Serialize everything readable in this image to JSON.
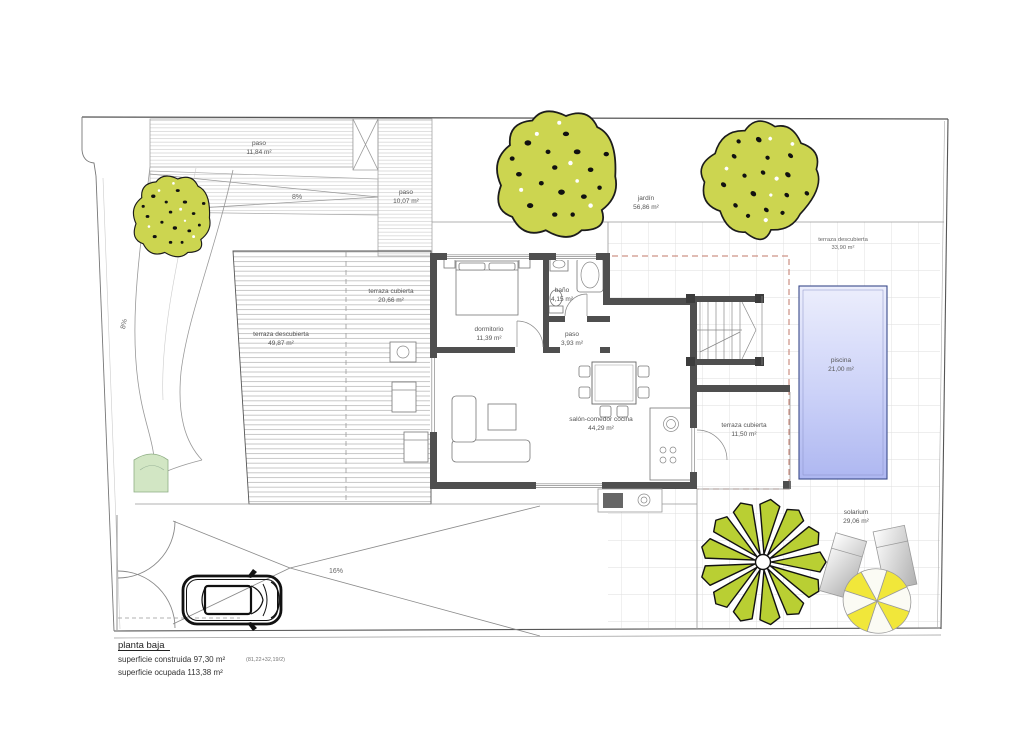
{
  "labels": {
    "paso_top": {
      "name": "paso",
      "area": "11,84 m²"
    },
    "paso_mid": {
      "name": "paso",
      "area": "10,07 m²"
    },
    "jardin": {
      "name": "jardín",
      "area": "56,86 m²"
    },
    "terraza_descubierta_ne": {
      "name": "terraza descubierta",
      "area": "33,90 m²"
    },
    "terraza_cubierta_oeste": {
      "name": "terraza cubierta",
      "area": "20,66 m²"
    },
    "terraza_descubierta_oeste": {
      "name": "terraza descubierta",
      "area": "49,87 m²"
    },
    "dormitorio": {
      "name": "dormitorio",
      "area": "11,39 m²"
    },
    "bano": {
      "name": "baño",
      "area": "4,15 m²"
    },
    "paso_interior": {
      "name": "paso",
      "area": "3,93 m²"
    },
    "salon": {
      "name": "salón-comedor cocina",
      "area": "44,29 m²"
    },
    "terraza_cubierta_este": {
      "name": "terraza cubierta",
      "area": "11,50 m²"
    },
    "piscina": {
      "name": "piscina",
      "area": "21,00 m²"
    },
    "solarium": {
      "name": "solarium",
      "area": "29,06 m²"
    }
  },
  "slopes": {
    "drive_top": "8%",
    "drive_side": "8%",
    "ramp_bottom": "16%"
  },
  "title_block": {
    "title": "planta baja",
    "built": "superficie construida 97,30 m²",
    "built_note": "(81,22+32,19/2)",
    "occupied": "superficie ocupada 113,38 m²"
  },
  "colors": {
    "wall": "#4f4f4f",
    "tree": "#ccd550",
    "palm": "#b9cf33",
    "grass": "#d2e6c4",
    "parasol": "#f1e73a",
    "pool_light": "#eceefc",
    "pool_dark": "#aeb7f1",
    "setback_dash": "#c27a6a"
  }
}
